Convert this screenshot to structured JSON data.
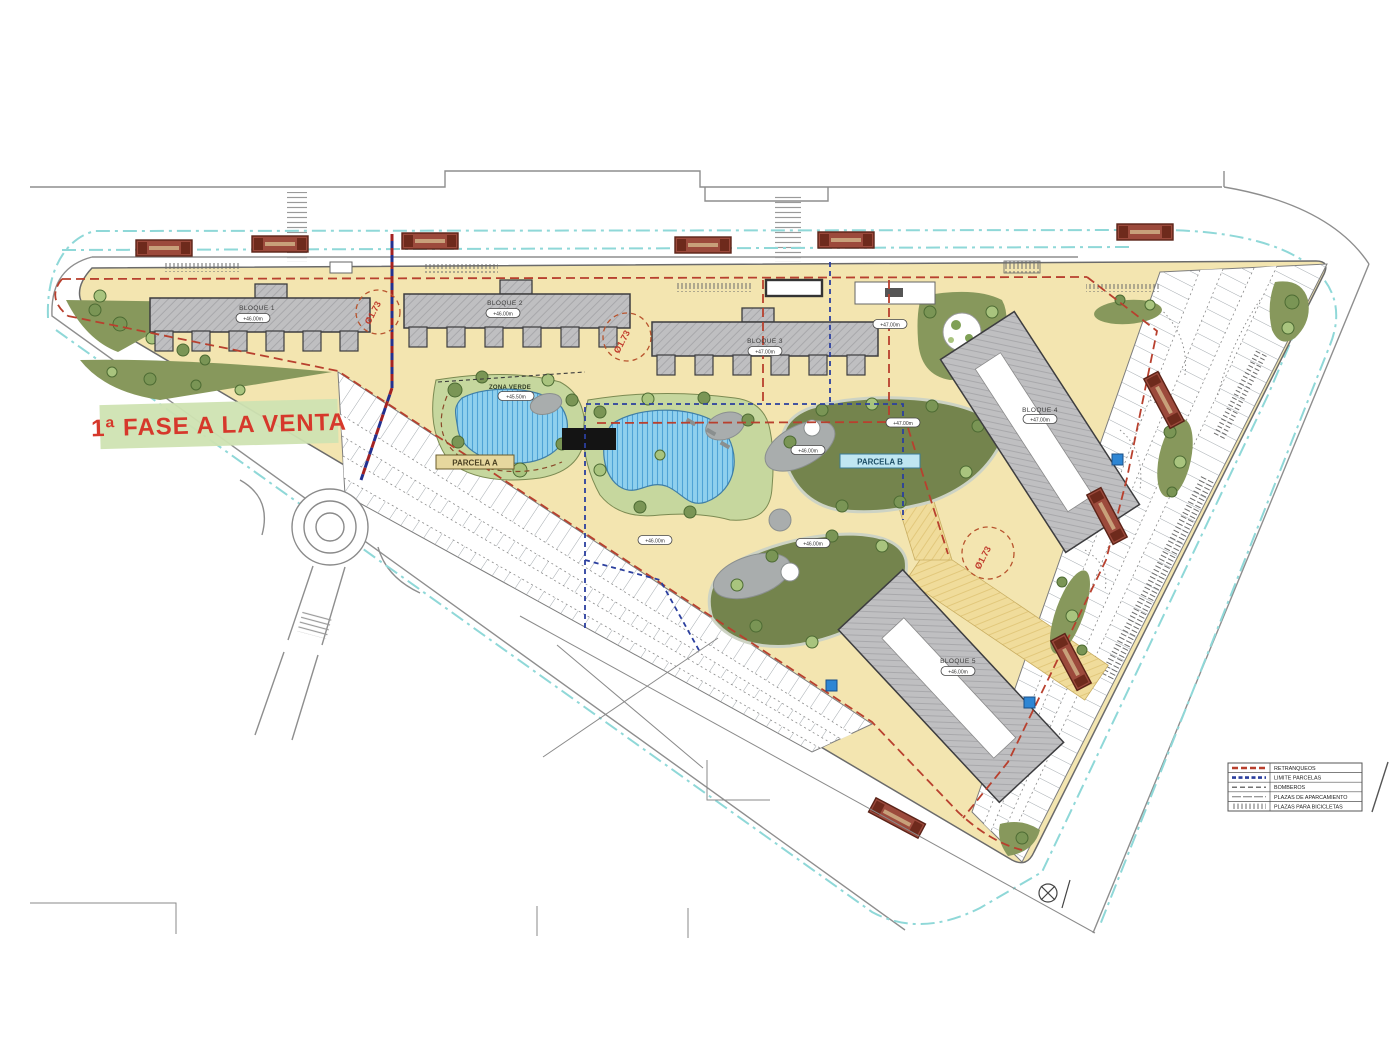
{
  "banner": {
    "label": "1ª FASE A LA VENTA"
  },
  "blocks": [
    {
      "name": "BLOQUE 1",
      "elevation": "+46.00m"
    },
    {
      "name": "BLOQUE 2",
      "elevation": "+46.00m"
    },
    {
      "name": "BLOQUE 3",
      "elevation": "+47.00m"
    },
    {
      "name": "BLOQUE 4",
      "elevation": "+47.00m"
    },
    {
      "name": "BLOQUE 5",
      "elevation": "+46.00m"
    }
  ],
  "zones": {
    "zona_verde": {
      "name": "ZONA VERDE",
      "elevation": "+45.50m"
    },
    "parcela_a": {
      "label": "PARCELA A"
    },
    "parcela_b": {
      "label": "PARCELA B"
    }
  },
  "spot_elevations": {
    "e1": "+47.00m",
    "e2": "+47.00m",
    "e3": "+46.00m",
    "e4": "+46.00m",
    "e5": "+46.00m"
  },
  "annotations": {
    "diameter": "Ø1.73"
  },
  "legend": {
    "items": [
      {
        "label": "RETRANQUEOS",
        "style": "red-dash"
      },
      {
        "label": "LIMITE PARCELAS",
        "style": "blue-dash"
      },
      {
        "label": "BOMBEROS",
        "style": "dark-dash"
      },
      {
        "label": "PLAZAS DE APARCAMIENTO",
        "style": "thin-line"
      },
      {
        "label": "PLAZAS PARA BICICLETAS",
        "style": "tick-hatch"
      }
    ]
  },
  "colors": {
    "site_yellow": "#f3e5b0",
    "building_gray": "#bfbfc1",
    "green_dark": "#74844d",
    "green_mid": "#87985c",
    "green_light": "#c6d79e",
    "pond_blue": "#8fd0ee",
    "retranqueo_red": "#b8402e",
    "parcel_blue": "#2b3f9e",
    "bike_lane_cyan": "#8fd8d8",
    "bench_red": "#9c4a3c",
    "banner_green": "#cfe3b2",
    "banner_text_red": "#d6382b"
  }
}
